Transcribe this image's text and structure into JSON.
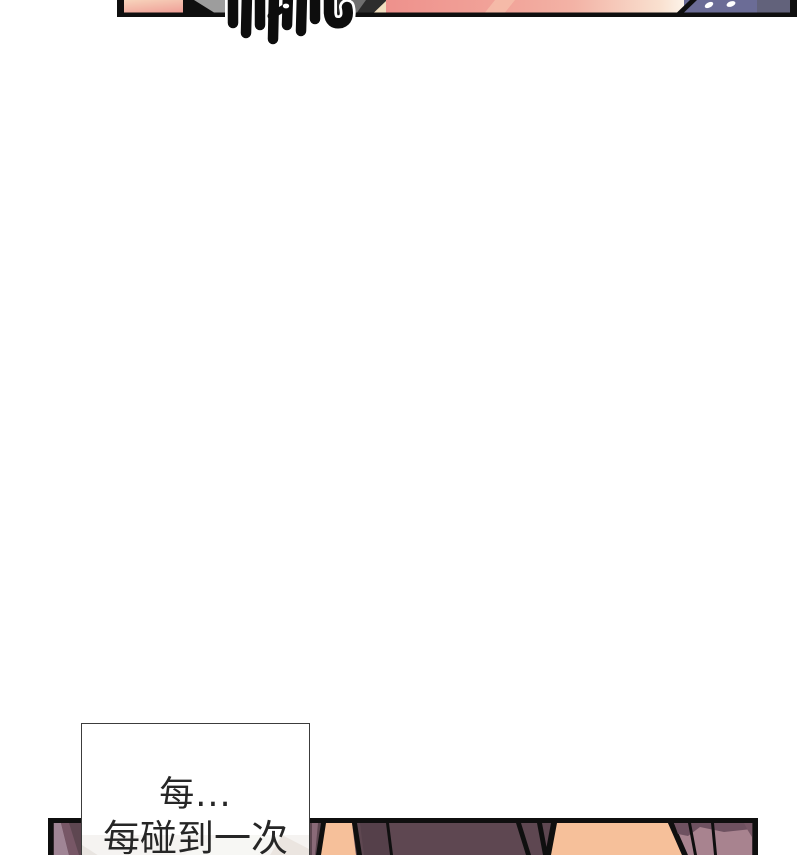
{
  "page": {
    "background": "#ffffff"
  },
  "speech_bubble": {
    "line1": "每...",
    "line2": "每碰到一次",
    "text_color": "#262626",
    "background": "#ffffff",
    "border_color": "#3c3c3c"
  },
  "palette": {
    "ink": "#0f0f0f",
    "white": "#ffffff",
    "skin_pink": "#ef9f97",
    "gray_wall": "#9d9d9d",
    "charcoal": "#2d2d2d",
    "gray_streak": "#6f6f6f",
    "cream_streak": "#f2dfc0",
    "pink_glow": "#f6c3ae",
    "slate_purple": "#6b6c96",
    "slate_dark": "#62627b",
    "plum": "#5e4751",
    "plum_dark": "#55404a",
    "plum_shadow": "#6e5160",
    "mauve_light": "#a08595",
    "mauve_mid": "#775766",
    "mauve_sliver": "#8a6a78",
    "rosy_surface": "#a8838f",
    "peach_skin": "#f6c09a"
  }
}
